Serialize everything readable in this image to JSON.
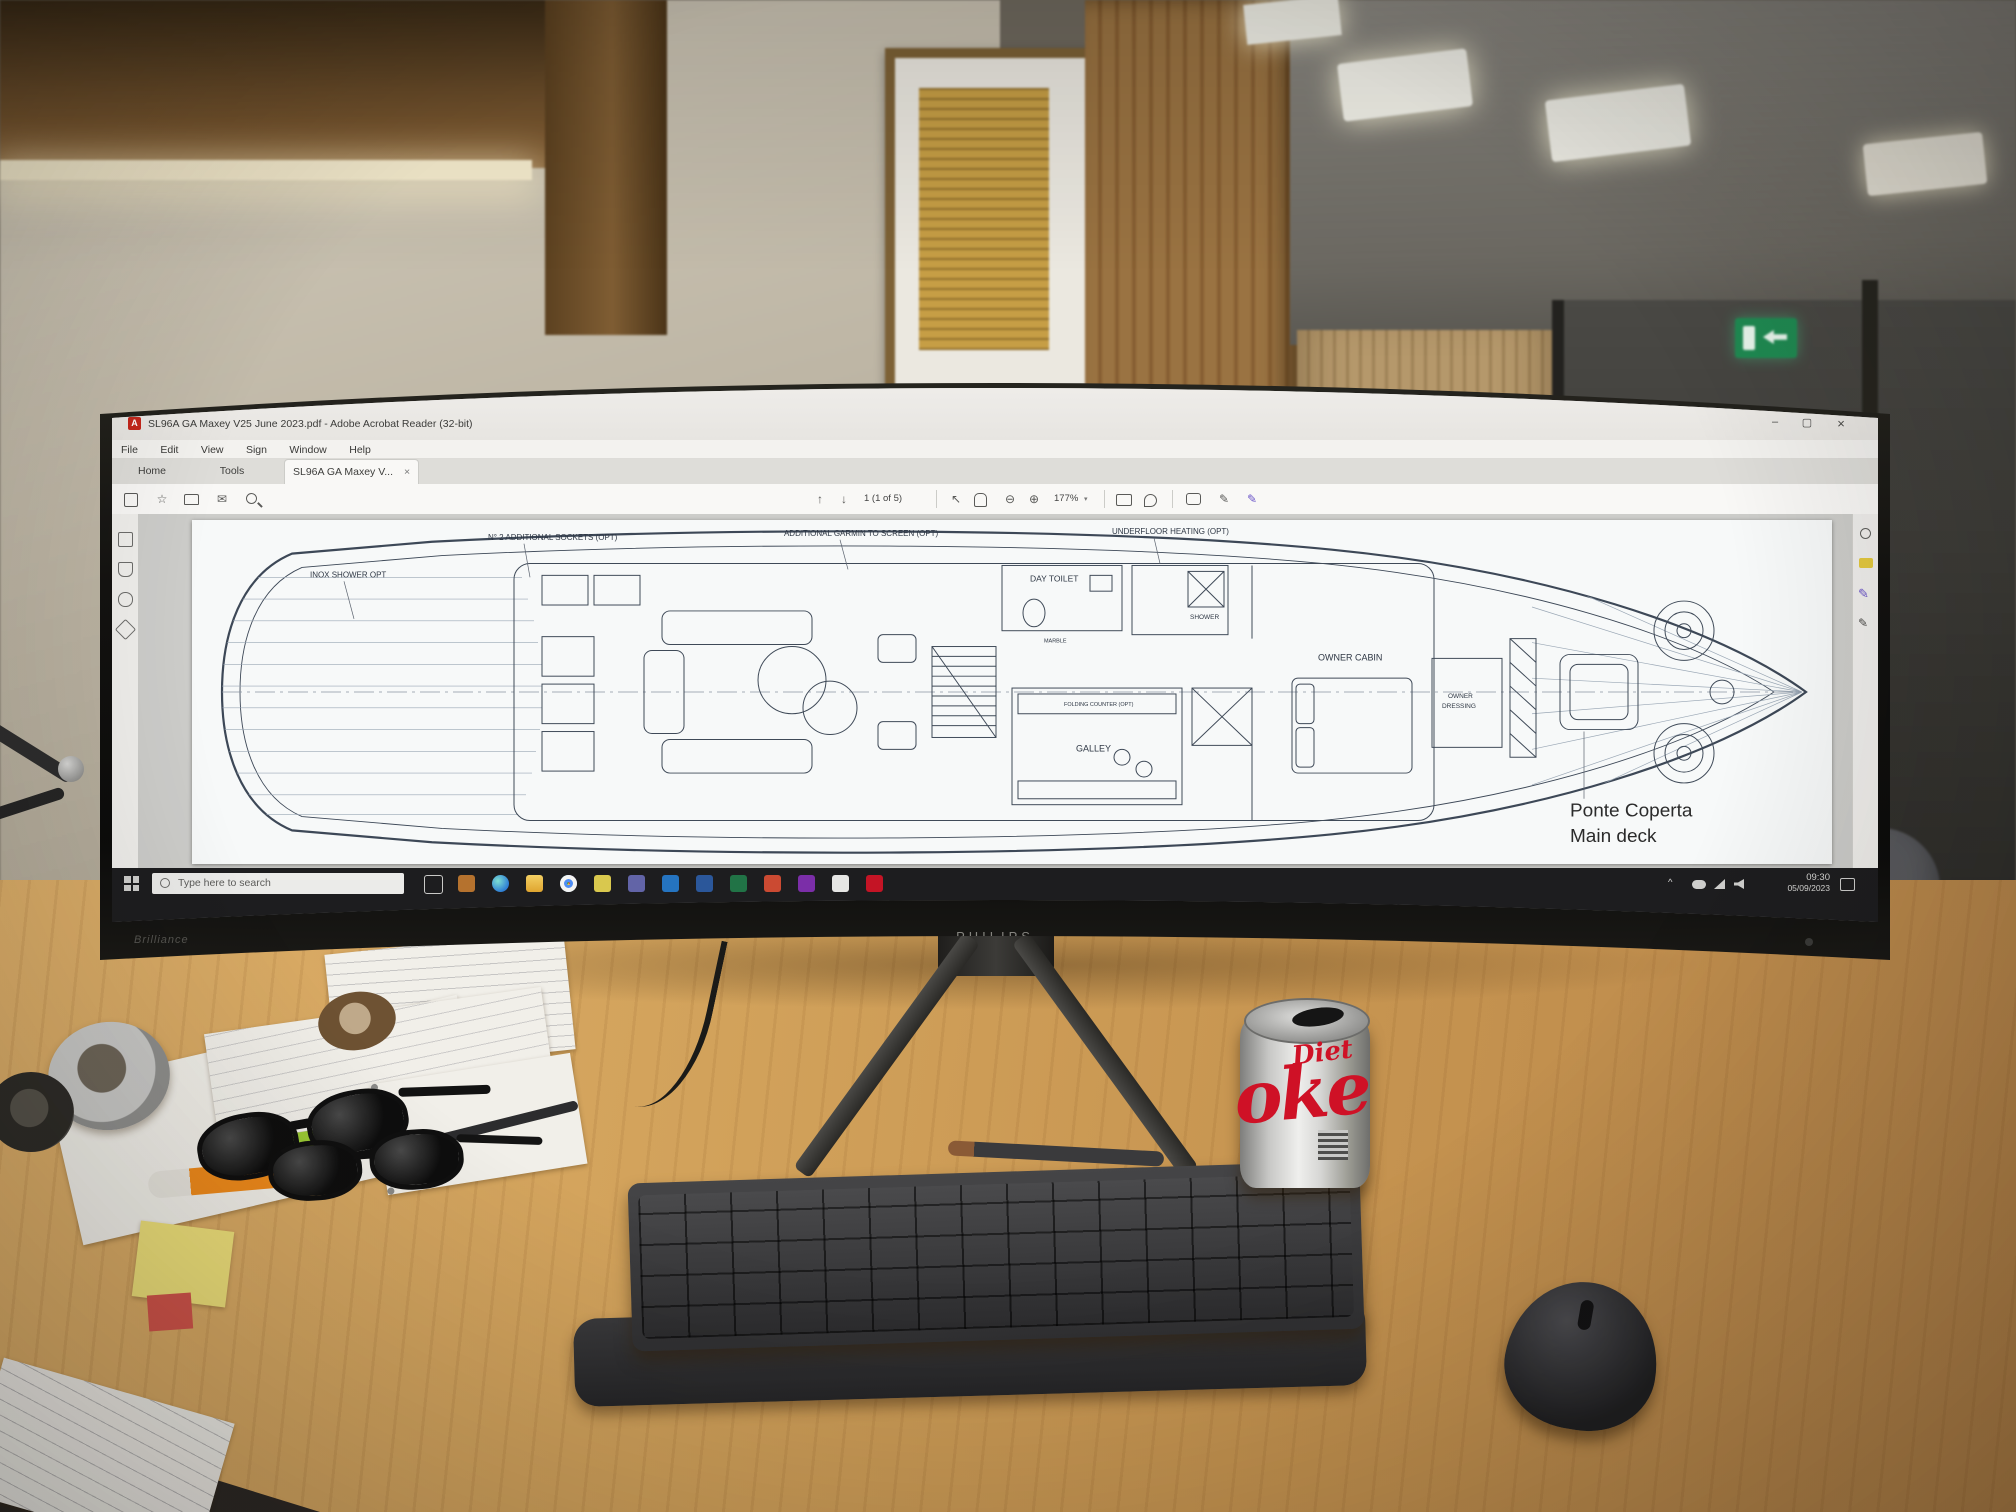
{
  "scene": {
    "description": "Office desk with ultrawide curved Philips monitor showing a yacht general-arrangement PDF in Adobe Acrobat Reader"
  },
  "monitor": {
    "brand": "PHILIPS",
    "model": "Brilliance"
  },
  "acrobat": {
    "title": "SL96A GA Maxey V25 June 2023.pdf - Adobe Acrobat Reader (32-bit)",
    "menus": [
      "File",
      "Edit",
      "View",
      "Sign",
      "Window",
      "Help"
    ],
    "tabs": {
      "home": "Home",
      "tools": "Tools",
      "document": "SL96A GA Maxey V...",
      "close_glyph": "×"
    },
    "toolbar": {
      "page_display": "1 (1 of 5)",
      "zoom_level": "177%",
      "zoom_caret": "▾"
    },
    "window_controls": {
      "minimize": "–",
      "maximize": "▢",
      "close": "×"
    }
  },
  "pdf": {
    "sheet_title_line1": "Ponte Coperta",
    "sheet_title_line2": "Main deck",
    "labels": [
      "INOX SHOWER OPT",
      "N° 2 ADDITIONAL SOCKETS (OPT)",
      "ADDITIONAL GARMIN TO SCREEN (OPT)",
      "UNDERFLOOR HEATING (OPT)",
      "DAY TOILET",
      "SHOWER",
      "MARBLE",
      "GALLEY",
      "OWNER CABIN",
      "OWNER",
      "DRESSING",
      "FOLDING COUNTER (OPT)"
    ]
  },
  "taskbar": {
    "search_placeholder": "Type here to search",
    "tray_caret": "^",
    "tray_time": "09:30",
    "tray_date": "05/09/2023"
  },
  "desk": {
    "can_line1": "Diet",
    "can_line2": "oke"
  }
}
